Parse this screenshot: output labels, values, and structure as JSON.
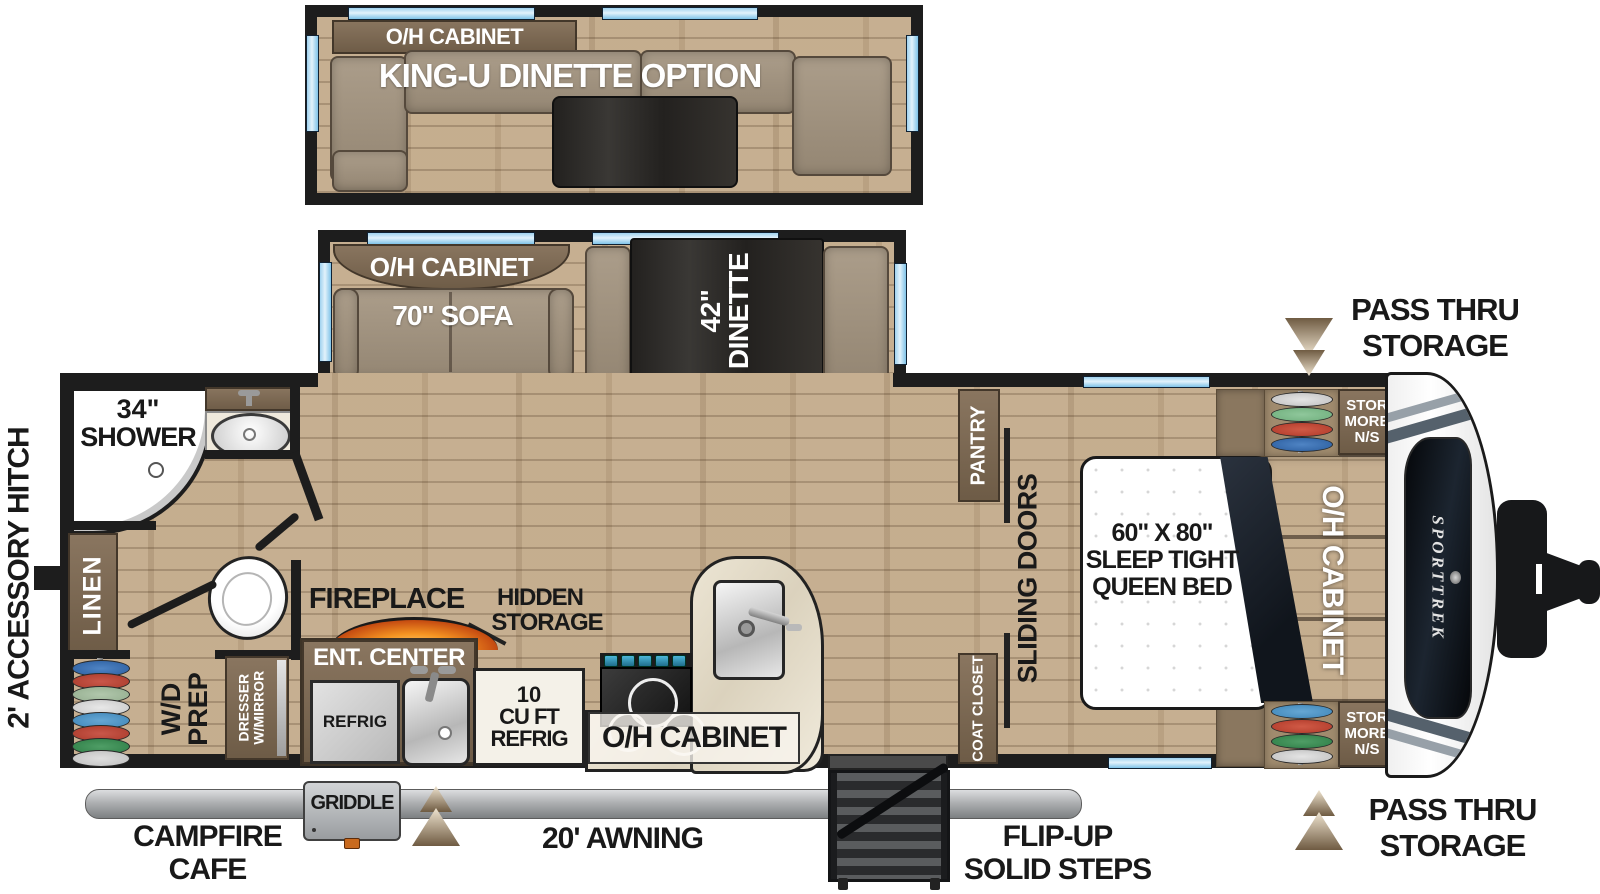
{
  "slide_option": {
    "oh_cabinet": "O/H CABINET",
    "title": "KING-U DINETTE OPTION"
  },
  "slide_main": {
    "oh_cabinet": "O/H CABINET",
    "sofa": "70\" SOFA",
    "dinette_l1": "42\"",
    "dinette_l2": "DINETTE"
  },
  "bathroom": {
    "shower_l1": "34\"",
    "shower_l2": "SHOWER",
    "linen": "LINEN"
  },
  "utility": {
    "wd_l1": "W/D",
    "wd_l2": "PREP",
    "dresser_l1": "DRESSER",
    "dresser_l2": "W/MIRROR"
  },
  "living": {
    "fireplace": "FIREPLACE",
    "hidden_l1": "HIDDEN",
    "hidden_l2": "STORAGE",
    "ent_center": "ENT. CENTER",
    "refrig": "REFRIG"
  },
  "kitchen": {
    "refrig_l1": "10",
    "refrig_l2": "CU FT",
    "refrig_l3": "REFRIG",
    "oh_cabinet": "O/H CABINET",
    "pantry": "PANTRY"
  },
  "hall": {
    "sliding_doors": "SLIDING DOORS",
    "coat_closet": "COAT CLOSET"
  },
  "bedroom": {
    "bed_l1": "60\" X 80\"",
    "bed_l2": "SLEEP TIGHT",
    "bed_l3": "QUEEN BED",
    "oh_cabinet": "O/H CABINET",
    "stor_l1": "STOR",
    "stor_l2": "MORE",
    "stor_l3": "N/S"
  },
  "exterior": {
    "pass_thru_top_l1": "PASS THRU",
    "pass_thru_top_l2": "STORAGE",
    "pass_thru_bottom_l1": "PASS THRU",
    "pass_thru_bottom_l2": "STORAGE",
    "accessory_hitch": "2' ACCESSORY HITCH",
    "campfire_l1": "CAMPFIRE",
    "campfire_l2": "CAFE",
    "griddle": "GRIDDLE",
    "awning": "20' AWNING",
    "steps_l1": "FLIP-UP",
    "steps_l2": "SOLID STEPS",
    "brand": "SPORTTREK"
  },
  "colors": {
    "wall": "#1d1d1d",
    "wood_floor": "#c3ab8b",
    "window_blue": "#9fd2ef",
    "cabinet_brown": "#7b6853",
    "cushion_tan": "#a1937f",
    "table_dark": "#2f2d2b",
    "counter_marble": "#e9e2d1",
    "awning_silver": "#b9babc",
    "fire_orange": "#f08c1e",
    "arrow_bronze": "#9b8466",
    "blanket_navy": "#151a22"
  },
  "wardrobe_hanger_colors": [
    "#2b5d9e",
    "#a93a2a",
    "#93ad8e",
    "#c8c8c8",
    "#3f86b8",
    "#a93a2a",
    "#2e7d46",
    "#bfbfbf"
  ],
  "stor_top_hanger_colors": [
    "#c0c0c0",
    "#6fae7c",
    "#b03a2a",
    "#2b5d9e"
  ],
  "stor_bottom_hanger_colors": [
    "#3f86b8",
    "#b03a2a",
    "#2e7d46",
    "#c0c0c0"
  ]
}
